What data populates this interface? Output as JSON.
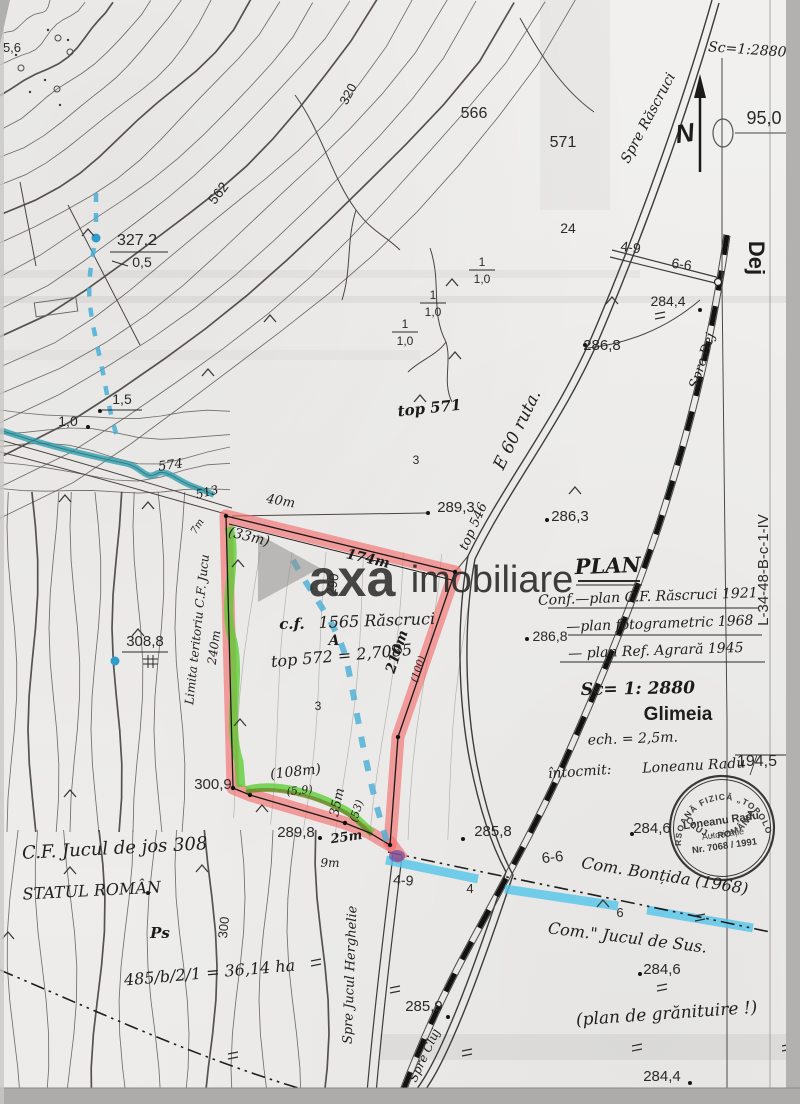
{
  "map": {
    "type": "scanned cadastral plan",
    "scale_handwritten": "Sc=1:2880",
    "colors": {
      "parcel_highlight": "#f4696b",
      "green_highlight": "#55cc2e",
      "cyan_highlight": "#53c6ea",
      "stream_teal": "#2e9fae",
      "blue_dash": "#49aed6",
      "red_ink": "#c03a3a",
      "dark_red_ink": "#7d1616",
      "blue_ink": "#2f4fc0"
    }
  },
  "watermark": {
    "logo": "axa-triangle",
    "word1": "axa",
    "word2": "imobiliare"
  },
  "stamp": {
    "outer_top": "PERSOANĂ FIZICĂ „TOPOLON”",
    "outer_bottom": "CLUJ - ROMÂNIA",
    "line1": "Loneanu Radu",
    "line2": "Autorizație",
    "line3": "Nr. 7068 / 1991"
  },
  "north_arrow_letter": "N",
  "labels": [
    {
      "t": "5,6",
      "x": 12,
      "y": 52,
      "cls": "pr",
      "s": 13
    },
    {
      "t": "562",
      "x": 222,
      "y": 196,
      "r": -52,
      "cls": "pr",
      "s": 14,
      "c": "#6a5f58"
    },
    {
      "t": "327,2",
      "x": 137,
      "y": 245,
      "cls": "pr",
      "s": 16
    },
    {
      "t": "0,5",
      "x": 142,
      "y": 267,
      "cls": "pr",
      "s": 14
    },
    {
      "t": "320",
      "x": 352,
      "y": 96,
      "r": -62,
      "cls": "pr",
      "s": 13,
      "c": "#777772"
    },
    {
      "t": "566",
      "x": 474,
      "y": 118,
      "cls": "pr",
      "s": 16
    },
    {
      "t": "571",
      "x": 563,
      "y": 147,
      "cls": "pr",
      "s": 16
    },
    {
      "t": "24",
      "x": 568,
      "y": 233,
      "cls": "pr",
      "s": 14
    },
    {
      "t": "4-9",
      "x": 630,
      "y": 252,
      "r": 8,
      "cls": "pr",
      "s": 14
    },
    {
      "t": "6-6",
      "x": 681,
      "y": 269,
      "r": 8,
      "cls": "pr",
      "s": 14
    },
    {
      "t": "284,4",
      "x": 668,
      "y": 306,
      "cls": "pr",
      "s": 14
    },
    {
      "t": "286,8",
      "x": 602,
      "y": 350,
      "cls": "pr",
      "s": 15
    },
    {
      "t": "Dej",
      "x": 749,
      "y": 258,
      "r": 90,
      "cls": "prb",
      "s": 22
    },
    {
      "t": "95,0",
      "x": 764,
      "y": 124,
      "cls": "pr",
      "s": 18
    },
    {
      "t": "Sc=1:2880",
      "x": 747,
      "y": 54,
      "r": 4,
      "cls": "hw",
      "s": 14,
      "c": "#8c3b2e"
    },
    {
      "t": "Spre Răscruci",
      "x": 652,
      "y": 120,
      "r": -62,
      "cls": "hw",
      "s": 14
    },
    {
      "t": "1,5",
      "x": 122,
      "y": 404,
      "cls": "pr",
      "s": 14
    },
    {
      "t": "1,0",
      "x": 68,
      "y": 426,
      "cls": "pr",
      "s": 14
    },
    {
      "t": "top 571",
      "x": 430,
      "y": 413,
      "r": -6,
      "cls": "hwb",
      "s": 15
    },
    {
      "t": "E 60 ruta.",
      "x": 522,
      "y": 432,
      "r": -64,
      "cls": "hw",
      "s": 17,
      "c": "#2f4fc0"
    },
    {
      "t": "top 546",
      "x": 477,
      "y": 528,
      "r": -66,
      "cls": "hw",
      "s": 13
    },
    {
      "t": "289,3",
      "x": 456,
      "y": 512,
      "cls": "pr",
      "s": 15
    },
    {
      "t": "286,3",
      "x": 570,
      "y": 521,
      "cls": "pr",
      "s": 15
    },
    {
      "t": "286,8",
      "x": 550,
      "y": 641,
      "cls": "pr",
      "s": 14
    },
    {
      "t": "3",
      "x": 416,
      "y": 464,
      "cls": "pr",
      "s": 12
    },
    {
      "t": "3",
      "x": 318,
      "y": 710,
      "cls": "pr",
      "s": 12
    },
    {
      "t": "40m",
      "x": 280,
      "y": 505,
      "r": 10,
      "cls": "hw",
      "s": 13
    },
    {
      "t": "(33m)",
      "x": 248,
      "y": 541,
      "r": 14,
      "cls": "hw",
      "s": 14
    },
    {
      "t": "174m",
      "x": 367,
      "y": 563,
      "r": 13,
      "cls": "hwb",
      "s": 14,
      "c": "#7d1616"
    },
    {
      "t": "290",
      "x": 337,
      "y": 585,
      "r": -80,
      "cls": "pr",
      "s": 13,
      "c": "#66625e"
    },
    {
      "t": "c.f.",
      "x": 292,
      "y": 629,
      "cls": "hwb",
      "s": 15
    },
    {
      "t": "1565 Răscruci",
      "x": 377,
      "y": 626,
      "r": -2,
      "cls": "hw",
      "s": 16
    },
    {
      "t": "A",
      "x": 334,
      "y": 645,
      "cls": "hwb",
      "s": 14
    },
    {
      "t": "top 572 = 2,7085",
      "x": 342,
      "y": 661,
      "r": -5,
      "cls": "hw",
      "s": 16
    },
    {
      "t": "210m",
      "x": 401,
      "y": 653,
      "r": -72,
      "cls": "hwb",
      "s": 14,
      "c": "#7d1616"
    },
    {
      "t": "(100)",
      "x": 421,
      "y": 670,
      "r": -72,
      "cls": "hw",
      "s": 10,
      "c": "#b23333"
    },
    {
      "t": "240m",
      "x": 218,
      "y": 648,
      "r": -82,
      "cls": "hw",
      "s": 12,
      "c": "#c03a3a"
    },
    {
      "t": "Limita teritoriu C.F. Jucu",
      "x": 201,
      "y": 630,
      "r": -84,
      "cls": "hw",
      "s": 12,
      "c": "#c03a3a"
    },
    {
      "t": "7m",
      "x": 200,
      "y": 528,
      "r": -58,
      "cls": "hw",
      "s": 10
    },
    {
      "t": "574",
      "x": 171,
      "y": 469,
      "r": -8,
      "cls": "hw",
      "s": 13
    },
    {
      "t": "513",
      "x": 208,
      "y": 496,
      "r": -14,
      "cls": "hw",
      "s": 12
    },
    {
      "t": "308,8",
      "x": 145,
      "y": 646,
      "cls": "pr",
      "s": 15
    },
    {
      "t": "300,9",
      "x": 213,
      "y": 789,
      "cls": "pr",
      "s": 15
    },
    {
      "t": "(108m)",
      "x": 296,
      "y": 776,
      "r": -6,
      "cls": "hw",
      "s": 14
    },
    {
      "t": "(5,9)",
      "x": 300,
      "y": 794,
      "r": -6,
      "cls": "hw",
      "s": 11,
      "c": "#c03a3a"
    },
    {
      "t": "289,8",
      "x": 296,
      "y": 837,
      "cls": "pr",
      "s": 15
    },
    {
      "t": "35m",
      "x": 341,
      "y": 803,
      "r": -78,
      "cls": "hw",
      "s": 13
    },
    {
      "t": "(53)",
      "x": 360,
      "y": 812,
      "r": -72,
      "cls": "hw",
      "s": 11
    },
    {
      "t": "25m",
      "x": 347,
      "y": 841,
      "r": -8,
      "cls": "hwb",
      "s": 13,
      "c": "#7d1616"
    },
    {
      "t": "9m",
      "x": 330,
      "y": 867,
      "cls": "hw",
      "s": 12
    },
    {
      "t": "4-9",
      "x": 403,
      "y": 885,
      "r": 4,
      "cls": "pr",
      "s": 14
    },
    {
      "t": "4",
      "x": 470,
      "y": 893,
      "cls": "pr",
      "s": 13
    },
    {
      "t": "6",
      "x": 620,
      "y": 917,
      "cls": "pr",
      "s": 13
    },
    {
      "t": "4",
      "x": 792,
      "y": 884,
      "cls": "pr",
      "s": 13
    },
    {
      "t": "6-6",
      "x": 553,
      "y": 862,
      "r": -6,
      "cls": "pr",
      "s": 15
    },
    {
      "t": "Com. Bonțida (1968)",
      "x": 664,
      "y": 881,
      "r": 9,
      "cls": "hw",
      "s": 16
    },
    {
      "t": "Com.\" Jucul de Sus.",
      "x": 627,
      "y": 943,
      "r": 7,
      "cls": "hw",
      "s": 16
    },
    {
      "t": "285,8",
      "x": 493,
      "y": 836,
      "cls": "pr",
      "s": 15
    },
    {
      "t": "284,6",
      "x": 652,
      "y": 833,
      "cls": "pr",
      "s": 15
    },
    {
      "t": "194,5",
      "x": 757,
      "y": 766,
      "cls": "pr",
      "s": 16
    },
    {
      "t": "întocmit:",
      "x": 580,
      "y": 776,
      "r": -4,
      "cls": "hw",
      "s": 14
    },
    {
      "t": "Loneanu Radu",
      "x": 694,
      "y": 770,
      "r": -3,
      "cls": "hw",
      "s": 14
    },
    {
      "t": "PLAN",
      "x": 608,
      "y": 573,
      "r": -2,
      "cls": "hwb",
      "s": 21
    },
    {
      "t": "Conf.—plan C.F. Răscruci 1921",
      "x": 648,
      "y": 601,
      "r": -2,
      "cls": "hw",
      "s": 14
    },
    {
      "t": "—plan fotogrametric 1968",
      "x": 660,
      "y": 628,
      "r": -2,
      "cls": "hw",
      "s": 14
    },
    {
      "t": "— plan Ref. Agrară 1945",
      "x": 656,
      "y": 655,
      "r": -2,
      "cls": "hw",
      "s": 14
    },
    {
      "t": "Sc= 1: 2880",
      "x": 638,
      "y": 694,
      "r": -1,
      "cls": "hwb",
      "s": 17
    },
    {
      "t": "Glimeia",
      "x": 678,
      "y": 720,
      "cls": "prb",
      "s": 19
    },
    {
      "t": "ech. = 2,5m.",
      "x": 633,
      "y": 743,
      "r": -2,
      "cls": "hw",
      "s": 14
    },
    {
      "t": "L-34-48-B-c-1-IV",
      "x": 768,
      "y": 570,
      "r": -90,
      "cls": "pr",
      "s": 15
    },
    {
      "t": "C.F. Jucul de jos 308",
      "x": 115,
      "y": 854,
      "r": -3,
      "cls": "hw",
      "s": 18
    },
    {
      "t": "STATUL ROMÂN",
      "x": 92,
      "y": 896,
      "r": -3,
      "cls": "hw",
      "s": 16
    },
    {
      "t": "Ps",
      "x": 160,
      "y": 938,
      "cls": "hwb",
      "s": 15
    },
    {
      "t": "485/b/2/1 = 36,14 ha",
      "x": 210,
      "y": 978,
      "r": -5,
      "cls": "hw",
      "s": 16
    },
    {
      "t": "300",
      "x": 228,
      "y": 928,
      "r": -84,
      "cls": "pr",
      "s": 13,
      "c": "#55514d"
    },
    {
      "t": "285,9",
      "x": 424,
      "y": 1011,
      "cls": "pr",
      "s": 15
    },
    {
      "t": "Spre Cluj",
      "x": 428,
      "y": 1057,
      "r": -65,
      "cls": "hw",
      "s": 12
    },
    {
      "t": "(plan de grănituire !)",
      "x": 667,
      "y": 1019,
      "r": -4,
      "cls": "hw",
      "s": 17,
      "c": "#d85a60"
    },
    {
      "t": "284,4",
      "x": 662,
      "y": 1081,
      "cls": "pr",
      "s": 15
    },
    {
      "t": "284,6",
      "x": 662,
      "y": 974,
      "cls": "pr",
      "s": 15
    },
    {
      "t": "Spre Jucul Herghelie",
      "x": 354,
      "y": 975,
      "r": -88,
      "cls": "hw",
      "s": 13
    },
    {
      "t": "Spre Dej",
      "x": 706,
      "y": 362,
      "r": -72,
      "cls": "hw",
      "s": 13
    }
  ],
  "fractions": [
    {
      "top": "1",
      "bottom": "1,0",
      "x": 482,
      "y": 271
    },
    {
      "top": "1",
      "bottom": "1,0",
      "x": 433,
      "y": 304
    },
    {
      "top": "1",
      "bottom": "1,0",
      "x": 405,
      "y": 333
    }
  ]
}
